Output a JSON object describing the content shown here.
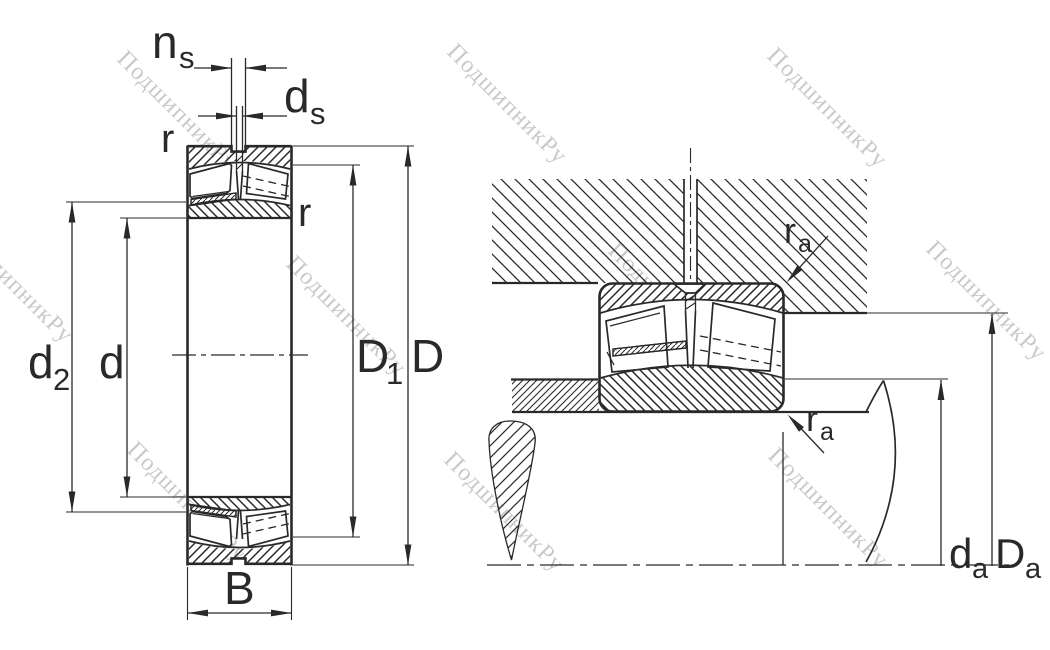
{
  "drawing": {
    "background": "#ffffff",
    "line_color": "#2b282a",
    "watermark": {
      "text": "ПодшипникРу",
      "color": "#c9c9c9"
    },
    "left_view": {
      "labels": {
        "ns_main": "n",
        "ns_sub": "s",
        "ds_main": "d",
        "ds_sub": "s",
        "r_outer": "r",
        "r_inner": "r",
        "d2_main": "d",
        "d2_sub": "2",
        "d_bore": "d",
        "D1_main": "D",
        "D1_sub": "1",
        "D_outer": "D",
        "B_width": "B"
      }
    },
    "right_view": {
      "labels": {
        "ra_housing_main": "r",
        "ra_housing_sub": "a",
        "ra_shaft_main": "r",
        "ra_shaft_sub": "a",
        "da_main": "d",
        "da_sub": "a",
        "Da_main": "D",
        "Da_sub": "a"
      }
    }
  }
}
